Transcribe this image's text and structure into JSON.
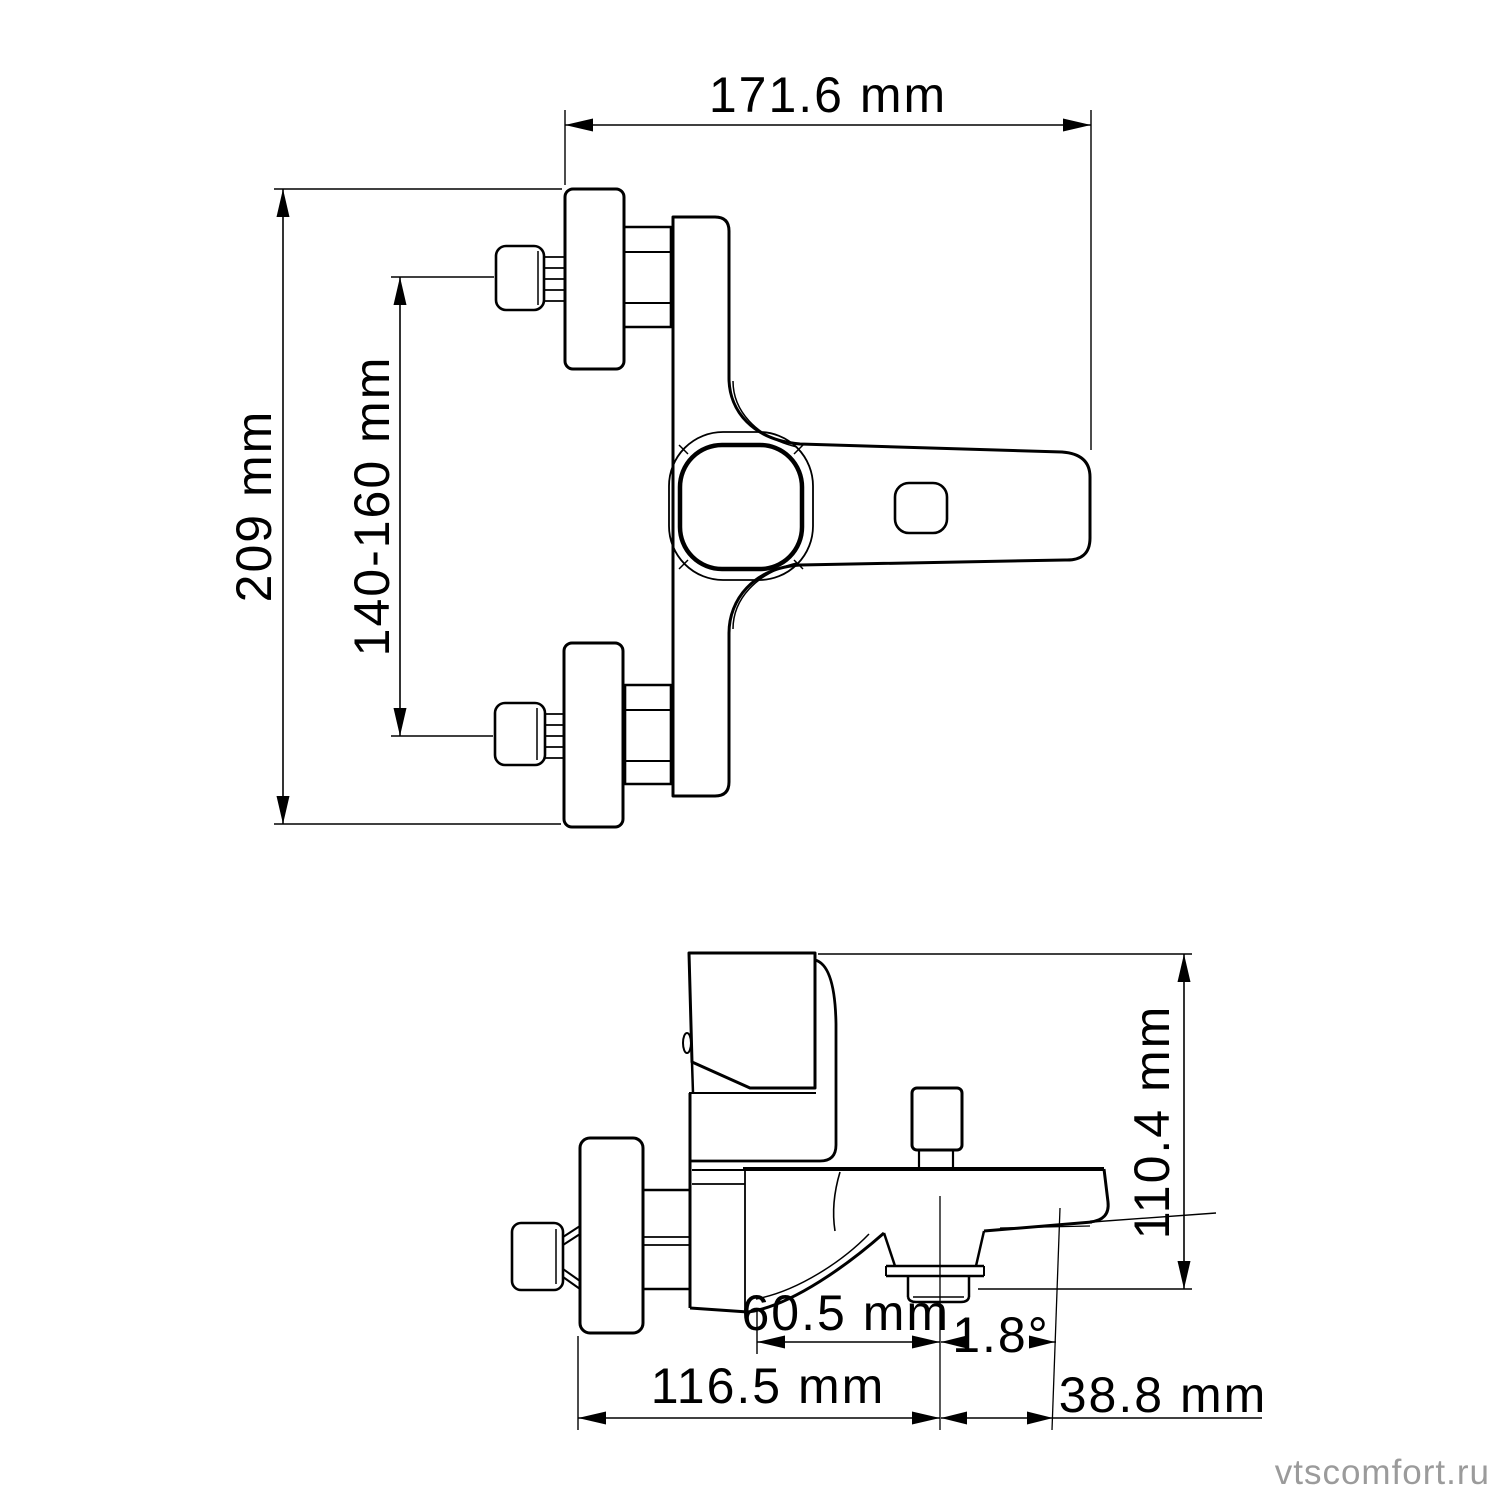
{
  "drawing": {
    "background": "#ffffff",
    "ink": "#000000",
    "front_view": {
      "width_dim": "171.6 mm",
      "height_dim": "209 mm",
      "mount_spacing_dim": "140-160 mm"
    },
    "side_view": {
      "height_dim": "110.4 mm",
      "spout_center_dim": "60.5 mm",
      "spout_angle_dim": "1.8°",
      "depth_dim": "116.5 mm",
      "tip_offset_dim": "38.8 mm"
    },
    "watermark": {
      "text": "vtscomfort.ru",
      "color": "#9b9b9b"
    }
  }
}
